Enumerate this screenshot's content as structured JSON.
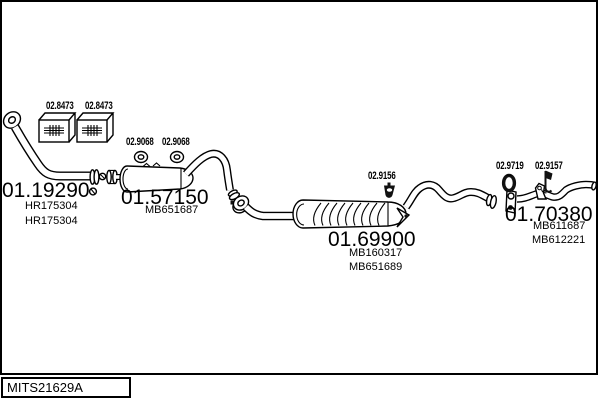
{
  "colors": {
    "ink": "#000000",
    "background": "#ffffff"
  },
  "parts": [
    {
      "number": "01.19290",
      "refs": [
        "HR175304",
        "HR175304"
      ]
    },
    {
      "number": "01.57150",
      "refs": [
        "MB651687"
      ]
    },
    {
      "number": "01.69900",
      "refs": [
        "MB160317",
        "MB651689"
      ]
    },
    {
      "number": "01.70380",
      "refs": [
        "MB611687",
        "MB612221"
      ]
    }
  ],
  "fittings": [
    {
      "number": "02.8473",
      "icon": "mount-block-icon"
    },
    {
      "number": "02.8473",
      "icon": "mount-block-icon"
    },
    {
      "number": "02.9068",
      "icon": "gasket-ring-icon"
    },
    {
      "number": "02.9068",
      "icon": "gasket-ring-icon"
    },
    {
      "number": "02.9156",
      "icon": "rubber-hanger-icon"
    },
    {
      "number": "02.9719",
      "icon": "rubber-grommet-icon"
    },
    {
      "number": "02.9157",
      "icon": "hook-bracket-icon"
    }
  ],
  "footer": {
    "code": "MITS21629A"
  }
}
